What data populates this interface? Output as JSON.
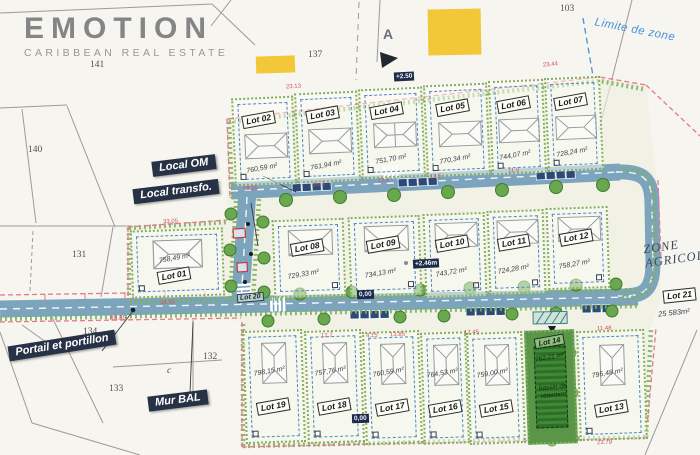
{
  "logo": {
    "title": "EMOTION",
    "subtitle": "CARIBBEAN REAL ESTATE"
  },
  "zone": {
    "title": "ZONE AGRICOLE"
  },
  "limite_de_zone": "Limite de zone",
  "callouts": {
    "local_om": "Local OM",
    "local_transfo": "Local transfo.",
    "portail": "Portail et portillon",
    "mur_bal": "Mur BAL"
  },
  "parcels": {
    "n141": "141",
    "n140": "140",
    "n131": "131",
    "n137": "137",
    "n103": "103",
    "n134": "134",
    "n132": "132",
    "n133": "133",
    "nc": "c",
    "marker_a": "A"
  },
  "badges": {
    "level_top": "+2.50",
    "level_mid": "+2.46m",
    "level_zero_road": "0,00",
    "level_zero_lot": "0,00"
  },
  "dims": [
    "23.13",
    "23.44",
    "33.05",
    "34.95",
    "18.35",
    "16.3",
    "13.4",
    "13.5",
    "11.9",
    "12.7",
    "4.15",
    "13.85",
    "17.45",
    "11.48",
    "23.79",
    "89.85"
  ],
  "lots": [
    {
      "label": "Lot 01",
      "area": "758,49 m²"
    },
    {
      "label": "Lot 02",
      "area": "760,59 m²"
    },
    {
      "label": "Lot 03",
      "area": "761,94 m²"
    },
    {
      "label": "Lot 04",
      "area": "751,70 m²"
    },
    {
      "label": "Lot 05",
      "area": "770,34 m²"
    },
    {
      "label": "Lot 06",
      "area": "744,07 m²"
    },
    {
      "label": "Lot 07",
      "area": "728,24 m²"
    },
    {
      "label": "Lot 08",
      "area": "729,33 m²"
    },
    {
      "label": "Lot 09",
      "area": "734,13 m²"
    },
    {
      "label": "Lot 10",
      "area": "743,72 m²"
    },
    {
      "label": "Lot 11",
      "area": "724,28 m²"
    },
    {
      "label": "Lot 12",
      "area": "758,27 m²"
    },
    {
      "label": "Lot 13",
      "area": "795,48 m²"
    },
    {
      "label": "Lot 14",
      "area": "762,21 m²",
      "note": "bassin de rétention"
    },
    {
      "label": "Lot 15",
      "area": "759,00 m²"
    },
    {
      "label": "Lot 16",
      "area": "764,53 m²"
    },
    {
      "label": "Lot 17",
      "area": "760,59 m²"
    },
    {
      "label": "Lot 18",
      "area": "757,76 m²"
    },
    {
      "label": "Lot 19",
      "area": "798,15 m²"
    },
    {
      "label": "Lot 20"
    },
    {
      "label": "Lot 21",
      "area": "25 583m²"
    }
  ]
}
